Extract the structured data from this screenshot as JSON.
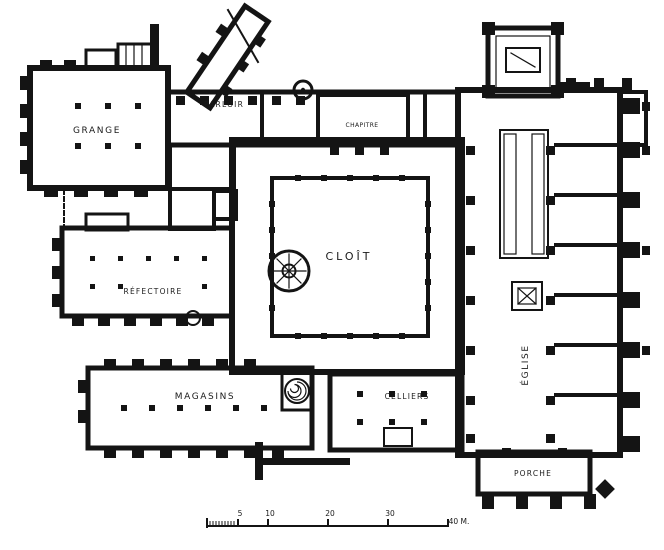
{
  "plan": {
    "rooms": {
      "grange": "GRANGE",
      "parloir": "PARLOIR",
      "chapitre": "CHAPITRE",
      "cloitre": "CLOÎT",
      "refectoire": "RÉFECTOIRE",
      "magasins": "MAGASINS",
      "celliers": "CELLIERS",
      "eglise": "ÉGLISE",
      "porche": "PORCHE"
    },
    "scale": {
      "labels": [
        "5",
        "10",
        "20",
        "30",
        "40 M."
      ]
    },
    "colors": {
      "ink": "#141414",
      "paper": "#ffffff"
    }
  }
}
